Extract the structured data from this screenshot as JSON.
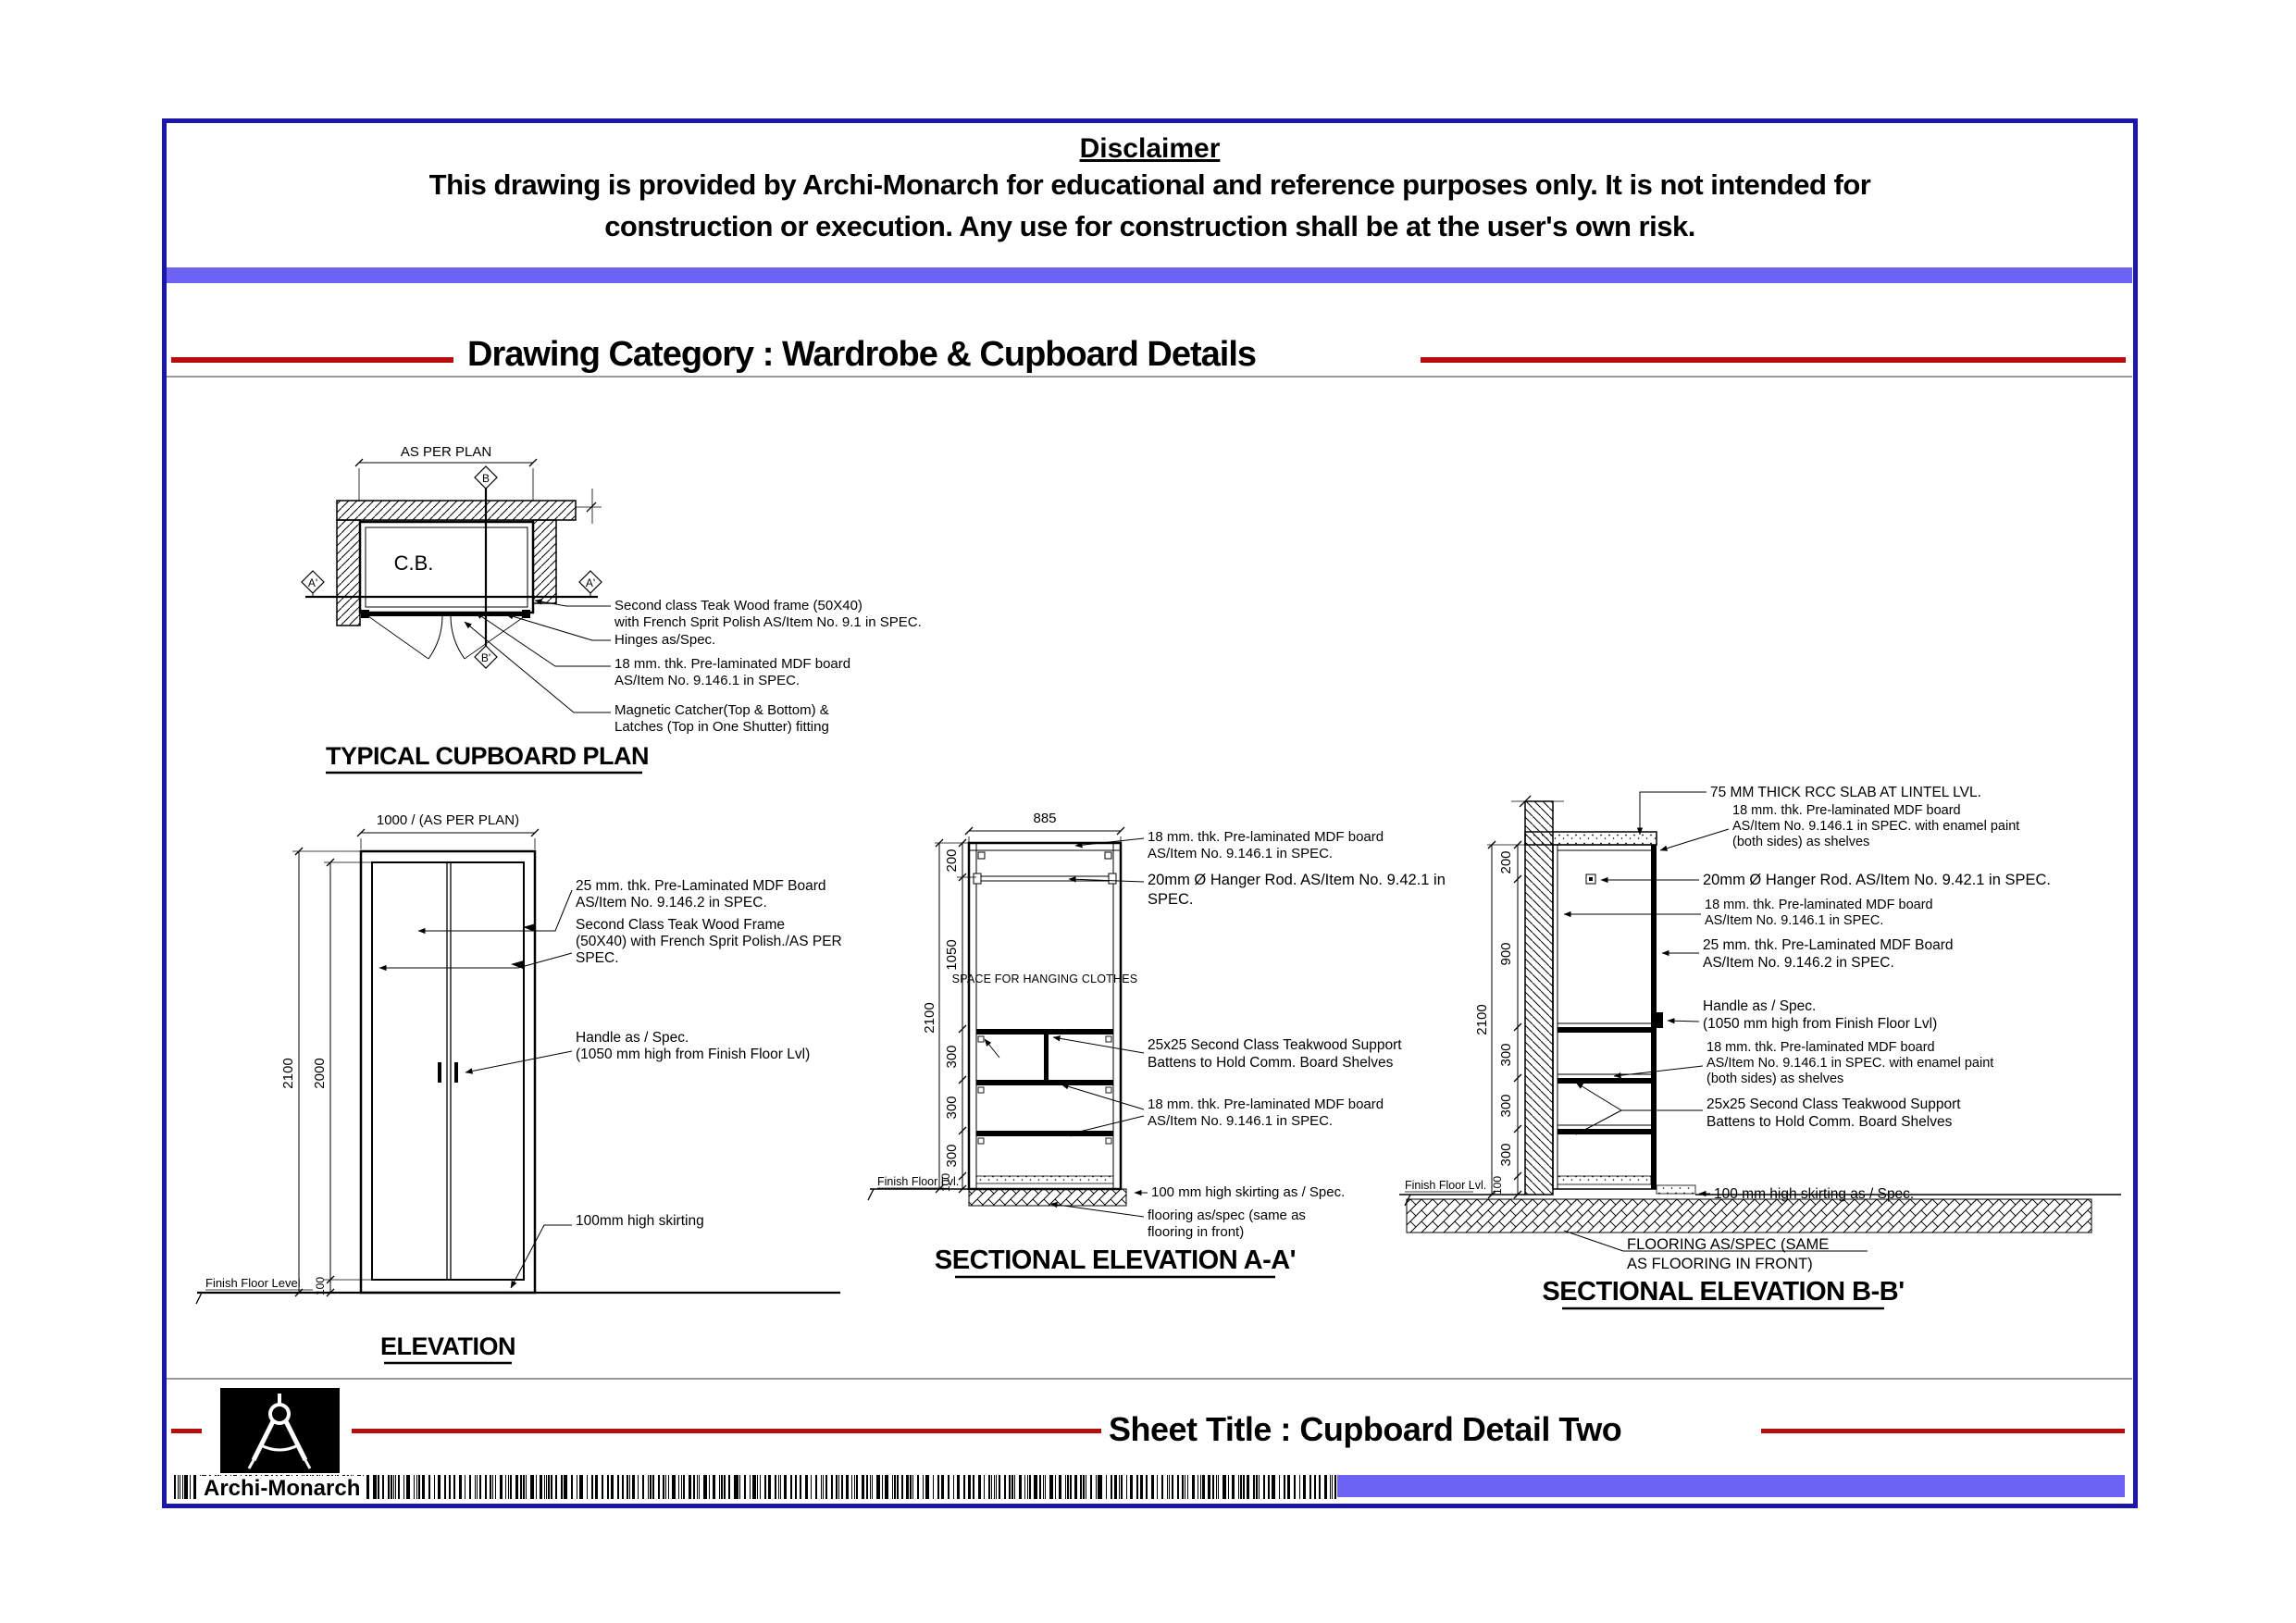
{
  "page": {
    "disclaimer": {
      "title": "Disclaimer",
      "line1": "This drawing is provided by Archi-Monarch for educational and reference purposes only. It is not intended for",
      "line2": "construction or execution. Any use for construction shall be at the user's own risk."
    },
    "category_title": "Drawing Category : Wardrobe & Cupboard Details",
    "sheet_title": "Sheet Title : Cupboard Detail Two",
    "brand": "Archi-Monarch"
  },
  "colors": {
    "accent_bar": "#6c63f2",
    "page_border": "#1c16aa",
    "rule_red": "#b80d0d",
    "separator_gray": "#9a9a9a"
  },
  "plan": {
    "title": "TYPICAL CUPBOARD PLAN",
    "dim_width": "AS PER PLAN",
    "cabinet_label": "C.B.",
    "marker_b": "B",
    "marker_b_prime": "B'",
    "marker_a_prime": "A'",
    "annotations": [
      {
        "lines": [
          "Second class Teak Wood frame (50X40)",
          "with French Sprit Polish AS/Item No. 9.1 in SPEC."
        ]
      },
      {
        "lines": [
          "Hinges as/Spec."
        ]
      },
      {
        "lines": [
          "18 mm. thk. Pre-laminated MDF board",
          "AS/Item No. 9.146.1 in SPEC."
        ]
      },
      {
        "lines": [
          "Magnetic Catcher(Top & Bottom) &",
          "Latches (Top in One Shutter) fitting"
        ]
      }
    ]
  },
  "elevation": {
    "title": "ELEVATION",
    "dim_width": "1000 / (AS PER PLAN)",
    "dim_total": "2100",
    "dim_door": "2000",
    "dim_skirt": "100",
    "ffl": "Finish Floor Level",
    "annotations": [
      {
        "lines": [
          "25 mm. thk. Pre-Laminated MDF Board",
          "AS/Item No. 9.146.2 in SPEC."
        ]
      },
      {
        "lines": [
          "Second Class Teak Wood Frame",
          "(50X40) with French Sprit Polish./AS PER",
          "SPEC."
        ]
      },
      {
        "lines": [
          "Handle as / Spec.",
          "(1050 mm high from Finish Floor Lvl)"
        ]
      },
      {
        "lines": [
          "100mm high skirting"
        ]
      }
    ]
  },
  "section_aa": {
    "title": "SECTIONAL ELEVATION A-A'",
    "dim_width": "885",
    "dim_total": "2100",
    "dims": [
      "200",
      "1050",
      "300",
      "300",
      "300",
      "100"
    ],
    "space_label": "SPACE FOR HANGING CLOTHES",
    "ffl": "Finish Floor Lvl.",
    "annotations": [
      {
        "lines": [
          "18 mm. thk. Pre-laminated MDF board",
          "AS/Item No. 9.146.1 in SPEC."
        ]
      },
      {
        "lines": [
          "20mm Ø Hanger Rod. AS/Item No. 9.42.1 in",
          "SPEC."
        ]
      },
      {
        "lines": [
          "25x25 Second Class Teakwood Support",
          "Battens to Hold Comm. Board Shelves"
        ]
      },
      {
        "lines": [
          "18 mm. thk. Pre-laminated MDF board",
          "AS/Item No. 9.146.1 in SPEC."
        ]
      },
      {
        "lines": [
          "100 mm high skirting as / Spec."
        ]
      },
      {
        "lines": [
          "flooring as/spec (same as",
          "flooring in front)"
        ]
      }
    ]
  },
  "section_bb": {
    "title": "SECTIONAL ELEVATION B-B'",
    "dim_total": "2100",
    "dims": [
      "200",
      "900",
      "300",
      "300",
      "300",
      "100"
    ],
    "ffl": "Finish Floor Lvl.",
    "annotations": [
      {
        "lines": [
          "75 MM THICK RCC SLAB AT LINTEL LVL."
        ]
      },
      {
        "lines": [
          "18 mm. thk. Pre-laminated MDF board",
          "AS/Item No. 9.146.1 in SPEC. with enamel paint",
          "(both sides) as shelves"
        ]
      },
      {
        "lines": [
          "20mm Ø Hanger Rod. AS/Item No. 9.42.1 in SPEC."
        ]
      },
      {
        "lines": [
          "18 mm. thk. Pre-laminated MDF board",
          "AS/Item No. 9.146.1 in SPEC."
        ]
      },
      {
        "lines": [
          "25 mm. thk. Pre-Laminated MDF Board",
          "AS/Item No. 9.146.2 in SPEC."
        ]
      },
      {
        "lines": [
          "Handle as / Spec.",
          "(1050 mm high from Finish Floor Lvl)"
        ]
      },
      {
        "lines": [
          "18 mm. thk. Pre-laminated MDF board",
          "AS/Item No. 9.146.1 in SPEC. with enamel paint",
          "(both sides) as shelves"
        ]
      },
      {
        "lines": [
          "25x25 Second Class Teakwood Support",
          "Battens to Hold Comm. Board Shelves"
        ]
      },
      {
        "lines": [
          "100 mm high skirting as / Spec."
        ]
      },
      {
        "lines": [
          "FLOORING AS/SPEC (SAME",
          "AS FLOORING IN FRONT)"
        ]
      }
    ]
  }
}
